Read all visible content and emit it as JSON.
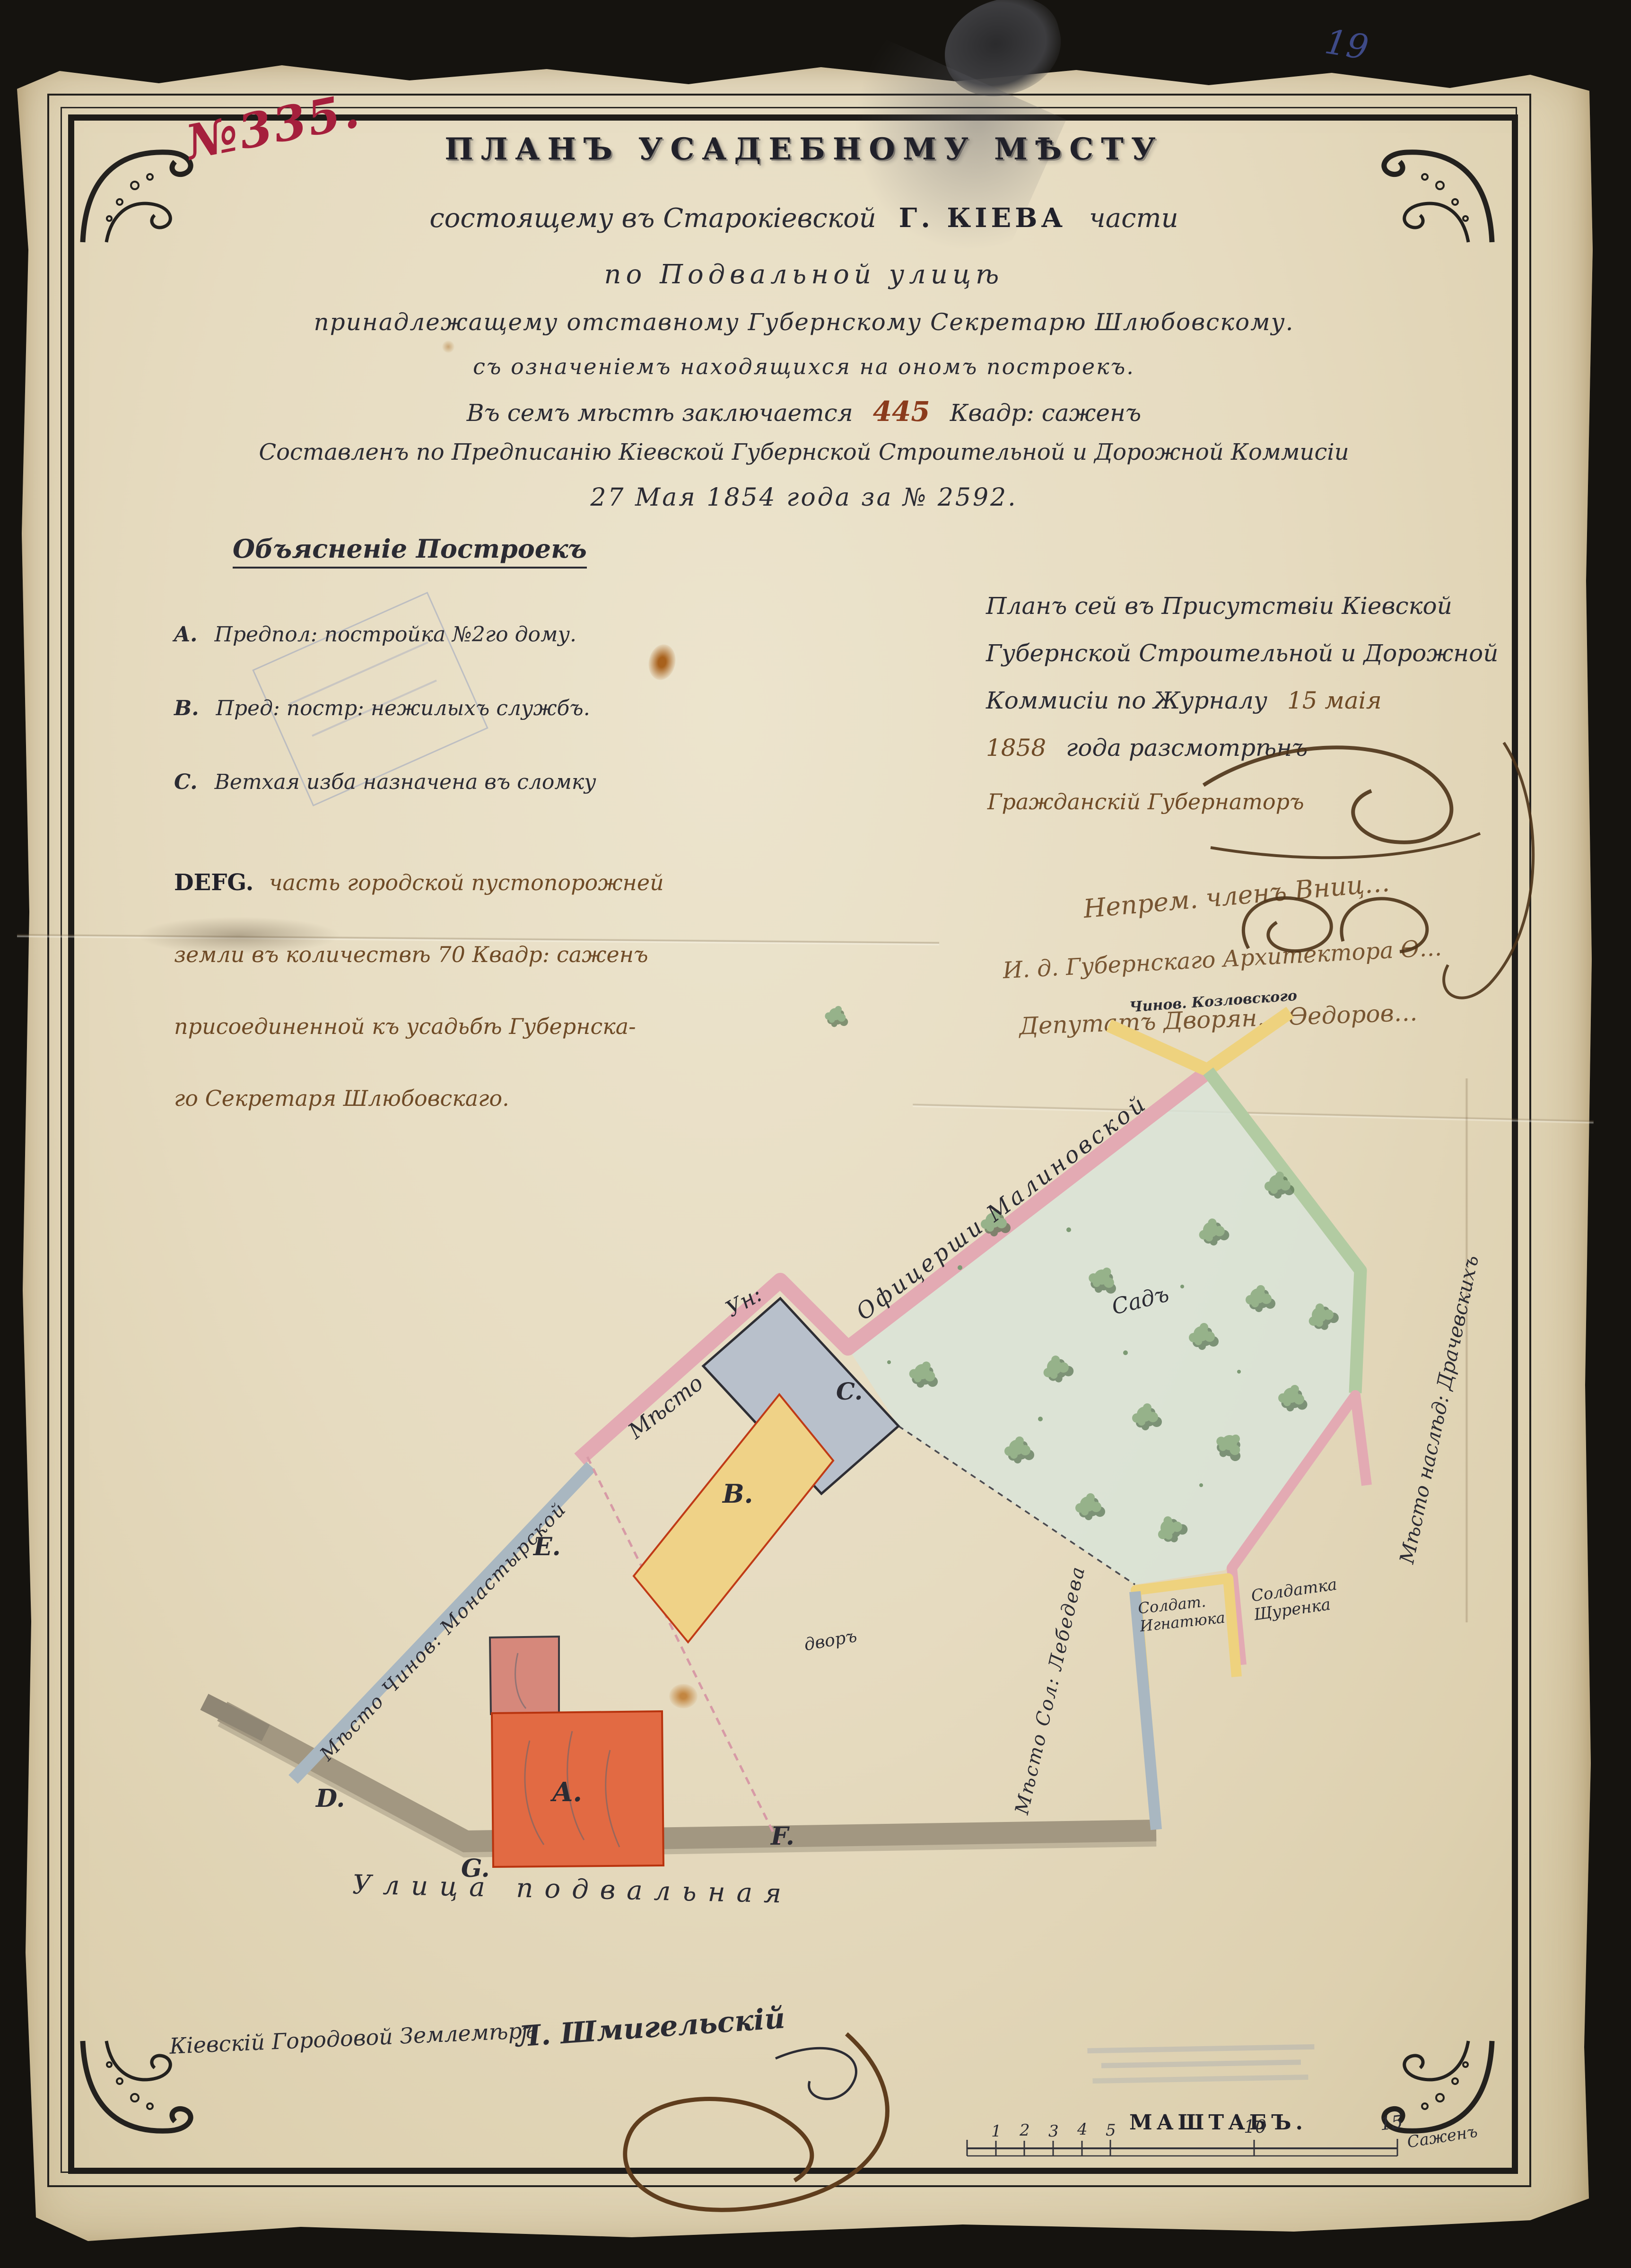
{
  "document": {
    "archive_no": "№335.",
    "page_no": "19",
    "title_main": "ПЛАНЪ УСАДЕБНОМУ МѢСТУ",
    "subtitle_pre": "состоящему въ Старокіевской",
    "subtitle_city": "Г. КІЕВА",
    "subtitle_post": "части",
    "subtitle_street": "по Подвальной улицѣ",
    "owner_line": "принадлежащему отставному Губернскому Секретарю Шлюбовскому.",
    "note_line": "съ означеніемъ находящихся на ономъ построекъ.",
    "area_pre": "Въ семъ мѣстѣ заключается",
    "area_value": "445",
    "area_post": "Квадр: саженъ",
    "commission_line": "Составленъ по Предписанію Кіевской Губернской Строительной и Дорожной Коммисіи",
    "date_line": "27 Мая 1854 года за № 2592."
  },
  "legend": {
    "heading": "Объясненіе Построекъ",
    "items": [
      {
        "key": "A.",
        "text": "Предпол: постройка №2го дому."
      },
      {
        "key": "B.",
        "text": "Пред: постр: нежилыхъ службъ."
      },
      {
        "key": "C.",
        "text": "Ветхая изба назначена въ сломку"
      }
    ],
    "defg_key": "DEFG.",
    "defg_lines": [
      "часть городской пустопорожней",
      "земли въ количествѣ 70 Квадр: саженъ",
      "присоединенной къ усадьбѣ Губернска-",
      "го Секретаря Шлюбовскаго."
    ]
  },
  "approval": {
    "line1": "Планъ сей въ Присутствіи Кіевской",
    "line2": "Губернской Строительной и Дорожной",
    "line3_pre": "Коммисіи по Журналу",
    "line3_date": "15 маія",
    "line4_year": "1858",
    "line4_post": "года разсмотрѣнъ",
    "governor": "Гражданскій Губернаторъ",
    "signatures": [
      "Непрем. членъ Вниц…",
      "И. д. Губернскаго Архитектора Ѳ…",
      "Депутатъ Дворян… Ѳедоров…"
    ],
    "clerk_note": "Чинов. Козловского"
  },
  "plan": {
    "points": {
      "a": "A.",
      "b": "B.",
      "c": "C.",
      "d": "D.",
      "e": "E.",
      "f": "F.",
      "g": "G."
    },
    "street": "Улица подвальная",
    "garden": "Садъ",
    "yard": "дворъ",
    "neighbors": {
      "road_prefix1": "Мѣсто",
      "road_prefix2": "Ун:",
      "road_owner": "Офицерши Малиновской",
      "left_owner": "Мѣсто Чинов: Монастырской",
      "right_owner": "Мѣсто Сол: Лебедева",
      "far_right_owner": "Мѣсто наслѣд: Драчевскихъ",
      "u1_line1": "Солдат.",
      "u1_line2": "Игнатюка",
      "u2_line1": "Солдатка",
      "u2_line2": "Щуренка"
    }
  },
  "scale": {
    "label": "МАШТАБЪ.",
    "t1": "1",
    "t2": "2",
    "t3": "3",
    "t4": "4",
    "t5": "5",
    "t10": "10",
    "t15": "15",
    "unit": "Саженъ"
  },
  "surveyor": {
    "title": "Кіевскій Городовой Землемѣръ",
    "name": "Л. Шмигельскій"
  },
  "colors": {
    "accent_red": "#a51f3c",
    "ink": "#2b2b33",
    "brown_ink": "#6e4a26",
    "band_pink": "#e3aab3",
    "band_yellow": "#eed27e",
    "band_green": "#b2cba2",
    "band_blue": "#a9b7c1",
    "building_red": "#e26a43",
    "building_gray": "#b8c0cb",
    "street_gray": "#a29781"
  }
}
